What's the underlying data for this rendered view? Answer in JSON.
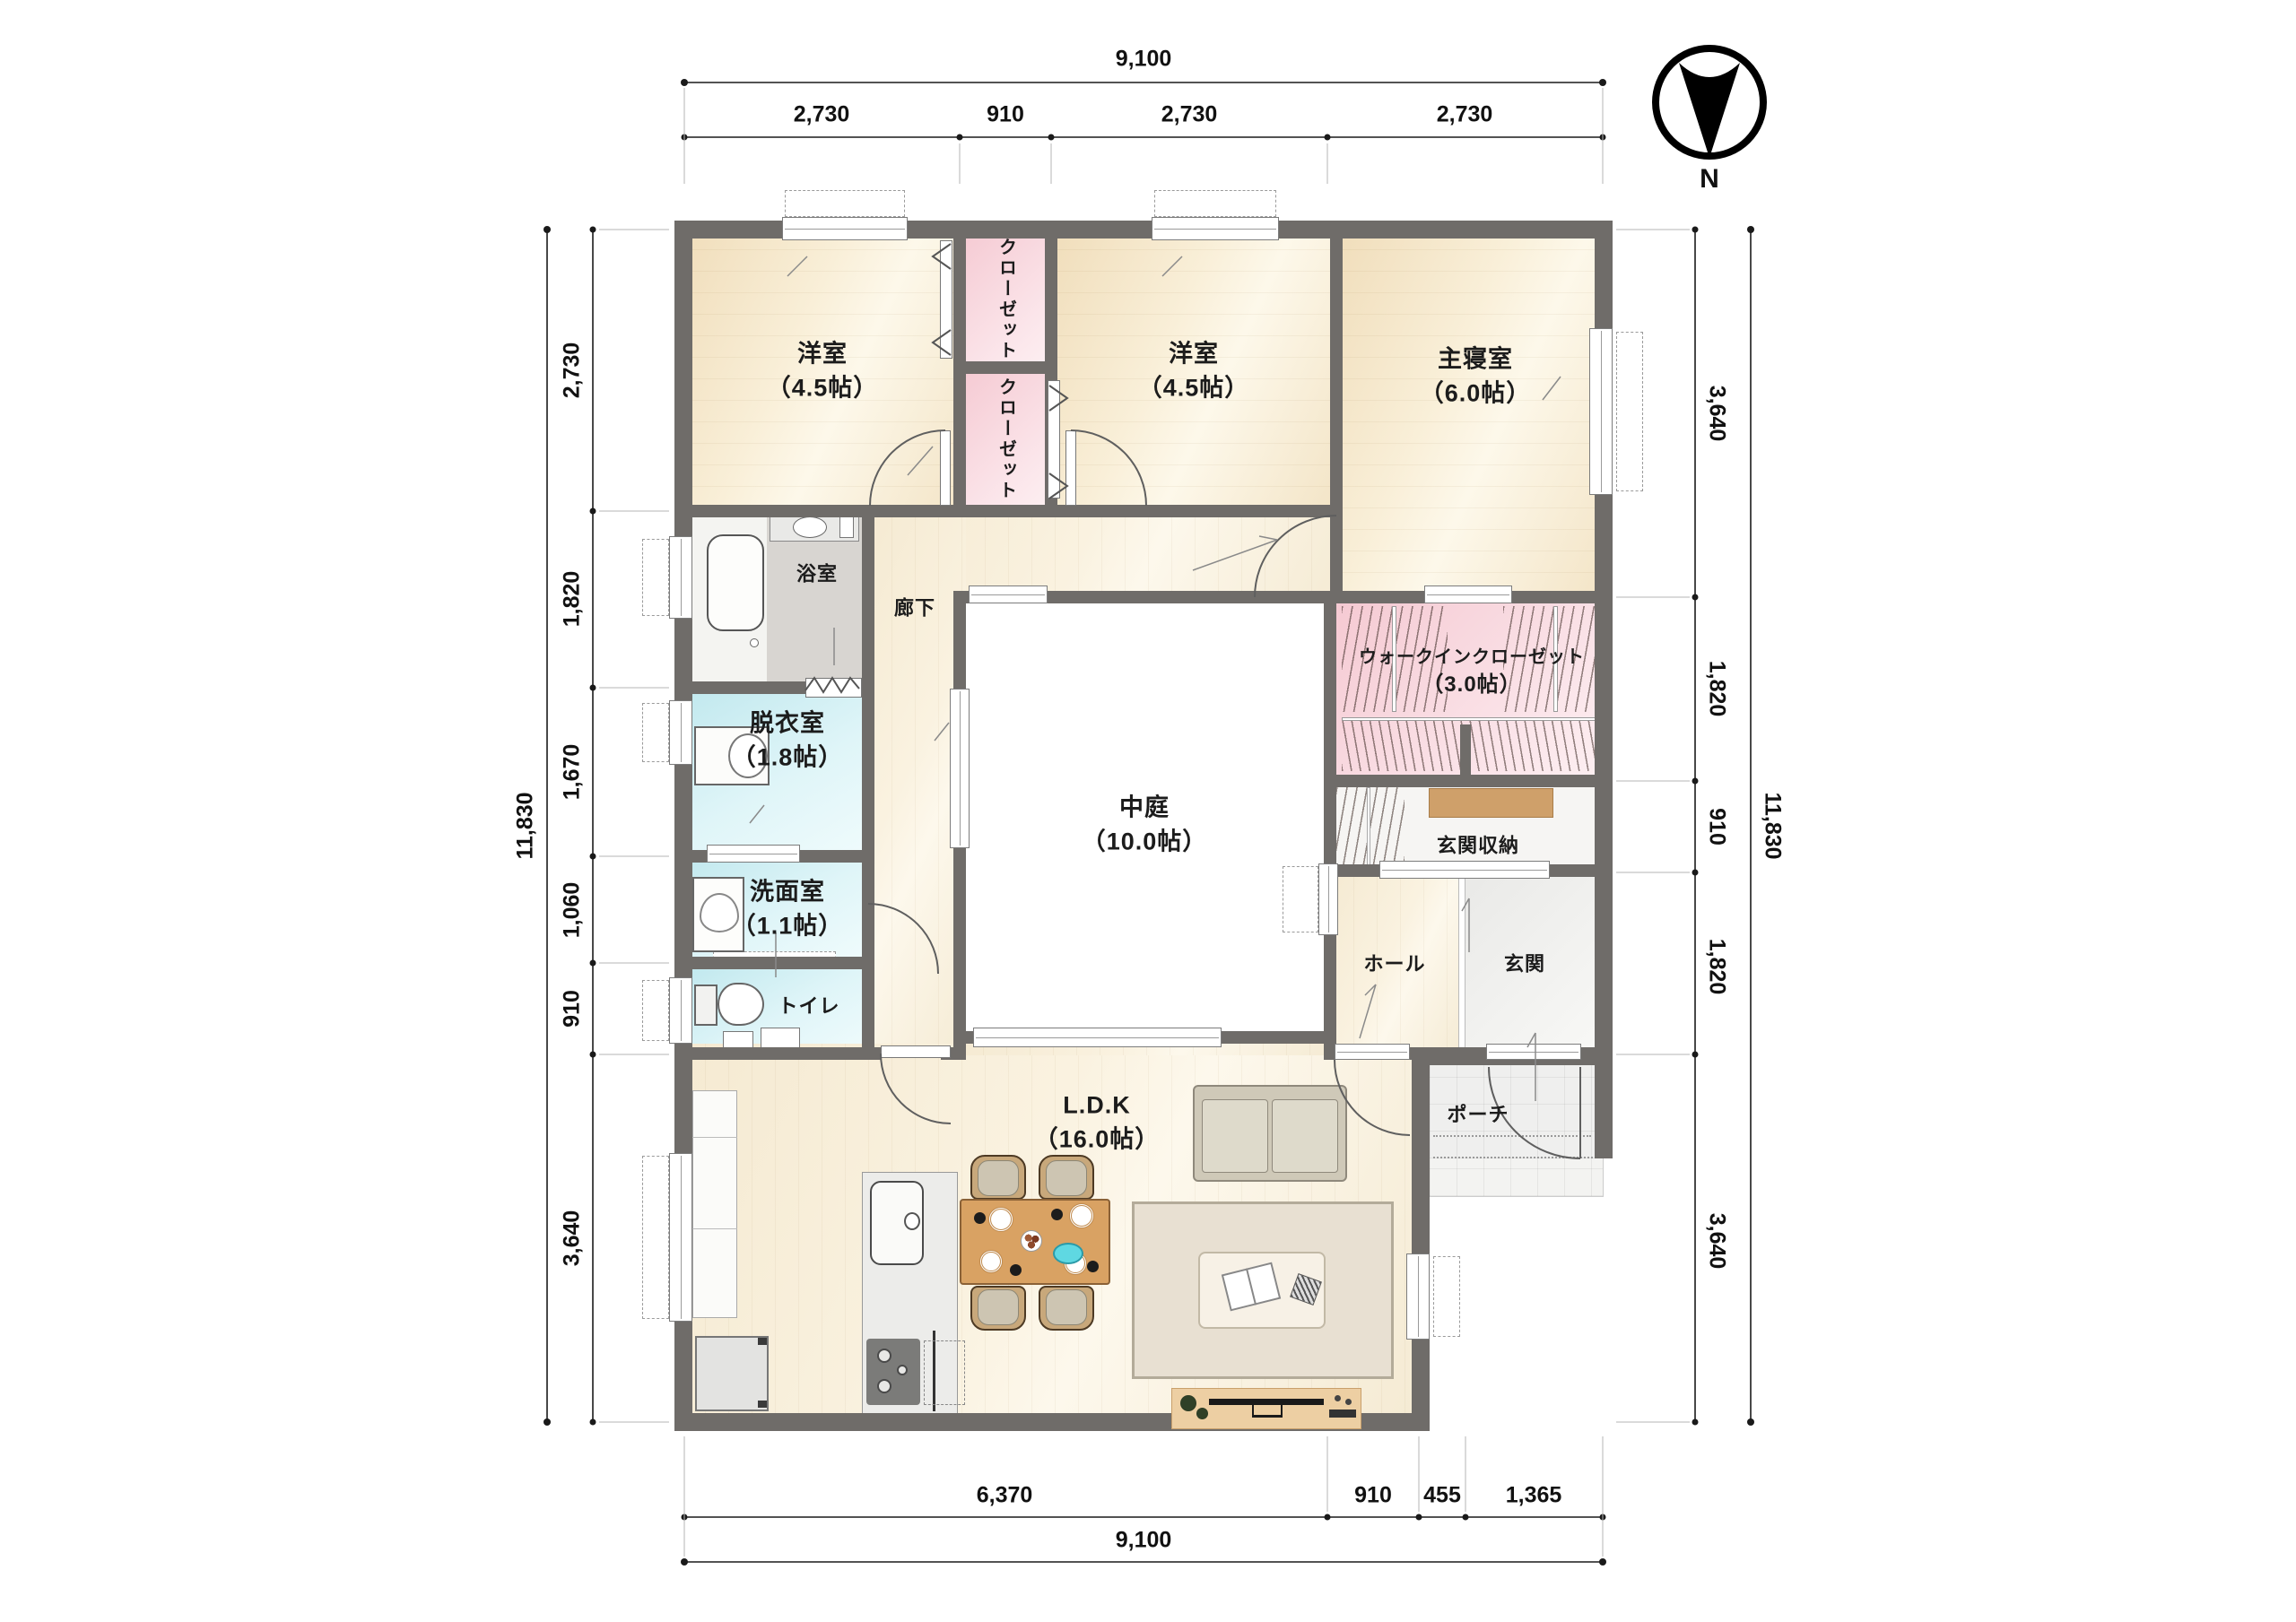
{
  "compass": {
    "label": "N"
  },
  "rooms": {
    "yoshitsu1": {
      "name": "洋室",
      "size": "（4.5帖）"
    },
    "closet1": {
      "name": "クローゼット"
    },
    "closet2": {
      "name": "クローゼット"
    },
    "yoshitsu2": {
      "name": "洋室",
      "size": "（4.5帖）"
    },
    "shushinshitsu": {
      "name": "主寝室",
      "size": "（6.0帖）"
    },
    "yokushitsu": {
      "name": "浴室"
    },
    "rouka": {
      "name": "廊下"
    },
    "datsuishitsu": {
      "name": "脱衣室",
      "size": "（1.8帖）"
    },
    "senmenshitsu": {
      "name": "洗面室",
      "size": "（1.1帖）"
    },
    "toire": {
      "name": "トイレ"
    },
    "nakaniwa": {
      "name": "中庭",
      "size": "（10.0帖）"
    },
    "wic": {
      "name": "ウォークインクローゼット",
      "size": "（3.0帖）"
    },
    "genkanshuno": {
      "name": "玄関収納"
    },
    "hall": {
      "name": "ホール"
    },
    "genkan": {
      "name": "玄関"
    },
    "porch": {
      "name": "ポーチ"
    },
    "ldk": {
      "name": "L.D.K",
      "size": "（16.0帖）"
    }
  },
  "dimensions": {
    "top": {
      "total": "9,100",
      "segments": [
        "2,730",
        "910",
        "2,730",
        "2,730"
      ]
    },
    "bottom": {
      "total": "9,100",
      "segments": [
        "6,370",
        "910",
        "455",
        "1,365"
      ]
    },
    "left": {
      "total": "11,830",
      "segments": [
        "2,730",
        "1,820",
        "1,670",
        "1,060",
        "910",
        "3,640"
      ]
    },
    "right": {
      "total": "11,830",
      "segments": [
        "3,640",
        "1,820",
        "910",
        "1,820",
        "3,640"
      ]
    }
  },
  "colors": {
    "wall": "#6f6c69",
    "wood_floor": "#f5e8cc",
    "closet_pink": "#f6ccd5",
    "wet_blue": "#cdedf2",
    "bath_gray": "#d8d5d1",
    "courtyard_white": "#ffffff",
    "cabinet_brown": "#cfa06a",
    "table_brown": "#d9a263",
    "dish_cyan": "#5fd8e2"
  }
}
